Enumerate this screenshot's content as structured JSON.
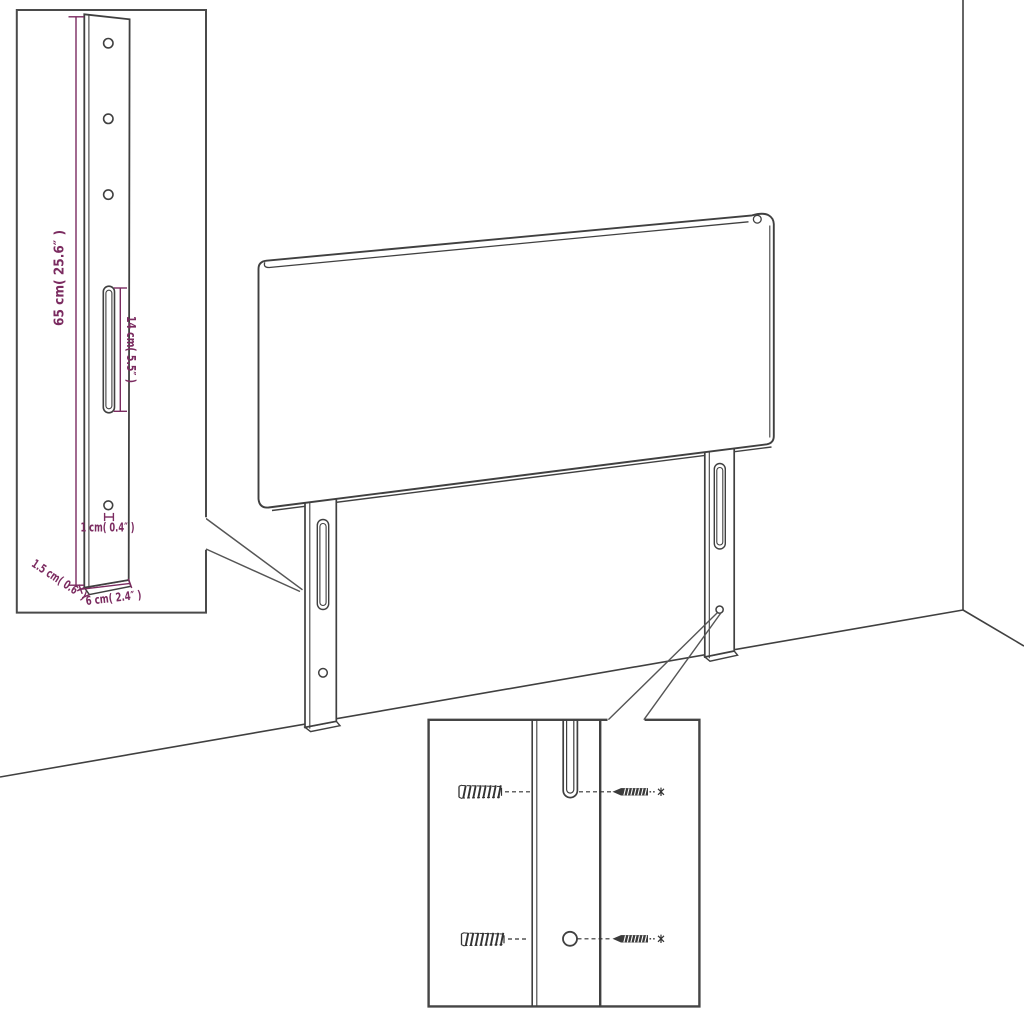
{
  "diagram": {
    "kind": "headboard-assembly-instruction",
    "colors": {
      "line": "#404040",
      "inset_border": "#4a4a4a",
      "dimension": "#7b2b60",
      "background": "#ffffff"
    },
    "leg_detail_inset": {
      "dim_height": "65 cm( 25.6″ )",
      "dim_slot": "14 cm( 5.5″ )",
      "dim_hole": "1 cm( 0.4″ )",
      "dim_thickness": "1.5 cm( 0.6″ )",
      "dim_width": "6 cm( 2.4″ )"
    }
  }
}
